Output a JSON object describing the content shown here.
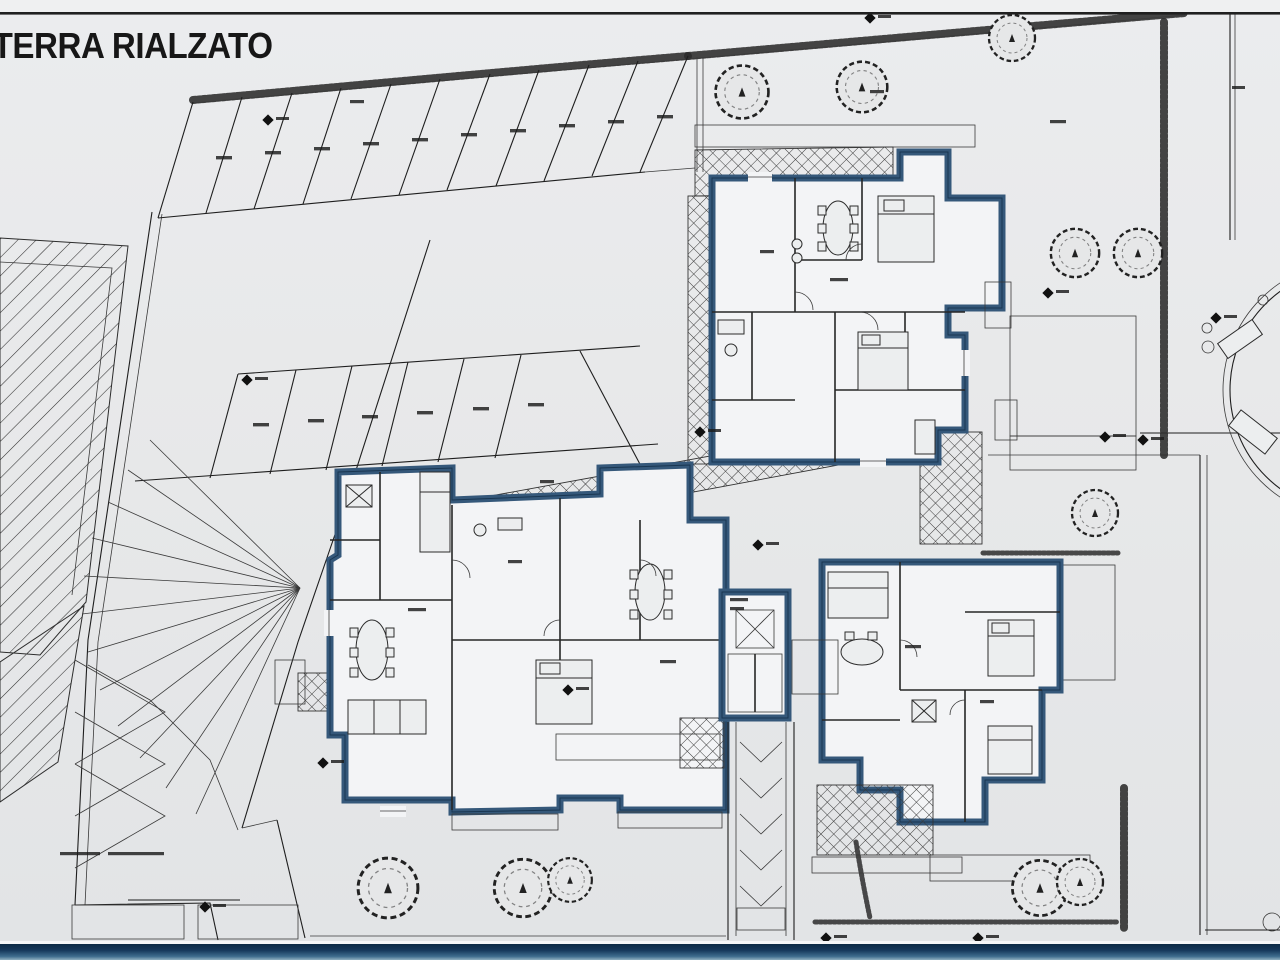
{
  "title": "TERRA RIALZATO",
  "plan": {
    "type_label": "architectural site plan, raised ground floor",
    "counts": {
      "parking_stalls_top_row": 10,
      "parking_stalls_middle_row": 6,
      "trees": 11
    },
    "features": [
      "two apartment buildings",
      "central stair and lift core",
      "access ramp",
      "cross-hatched terraces",
      "parking stalls",
      "gardens with trees and hedges",
      "roundabout at right edge"
    ]
  },
  "colors": {
    "paper": "#e8e9ea",
    "ink": "#1e1e1e",
    "wall": "#35587a",
    "room": "#f3f4f6",
    "hatch": "#2e2e2e",
    "bar_top": "#0c2a44",
    "bar_bottom": "#8fb0c0"
  }
}
